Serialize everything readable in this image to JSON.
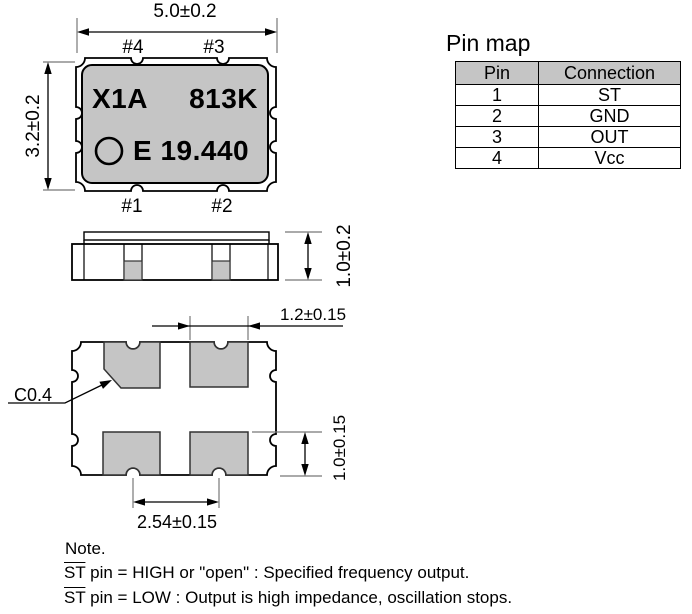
{
  "top_view": {
    "width_dim": "5.0±0.2",
    "height_dim": "3.2±0.2",
    "pin4_label": "#4",
    "pin3_label": "#3",
    "pin1_label": "#1",
    "pin2_label": "#2",
    "marking_line1_left": "X1A",
    "marking_line1_right": "813K",
    "marking_line2": "E 19.440"
  },
  "side_view": {
    "height_dim": "1.0±0.2"
  },
  "bottom_view": {
    "pad_width_dim": "1.2±0.15",
    "pad_height_dim": "1.0±0.15",
    "pad_pitch_dim": "2.54±0.15",
    "chamfer_label": "C0.4"
  },
  "pin_map": {
    "title": "Pin map",
    "headers": [
      "Pin",
      "Connection"
    ],
    "rows": [
      {
        "pin": "1",
        "connection": "ST"
      },
      {
        "pin": "2",
        "connection": "GND"
      },
      {
        "pin": "3",
        "connection": "OUT"
      },
      {
        "pin": "4",
        "connection": "Vcc"
      }
    ]
  },
  "note": {
    "title": "Note.",
    "st_label": "ST",
    "line1_rest": " pin = HIGH or \"open\" : Specified frequency output.",
    "line2_rest": " pin = LOW : Output is high impedance, oscillation stops."
  },
  "colors": {
    "body_gray": "#c5c5c5",
    "line_black": "#000000"
  }
}
